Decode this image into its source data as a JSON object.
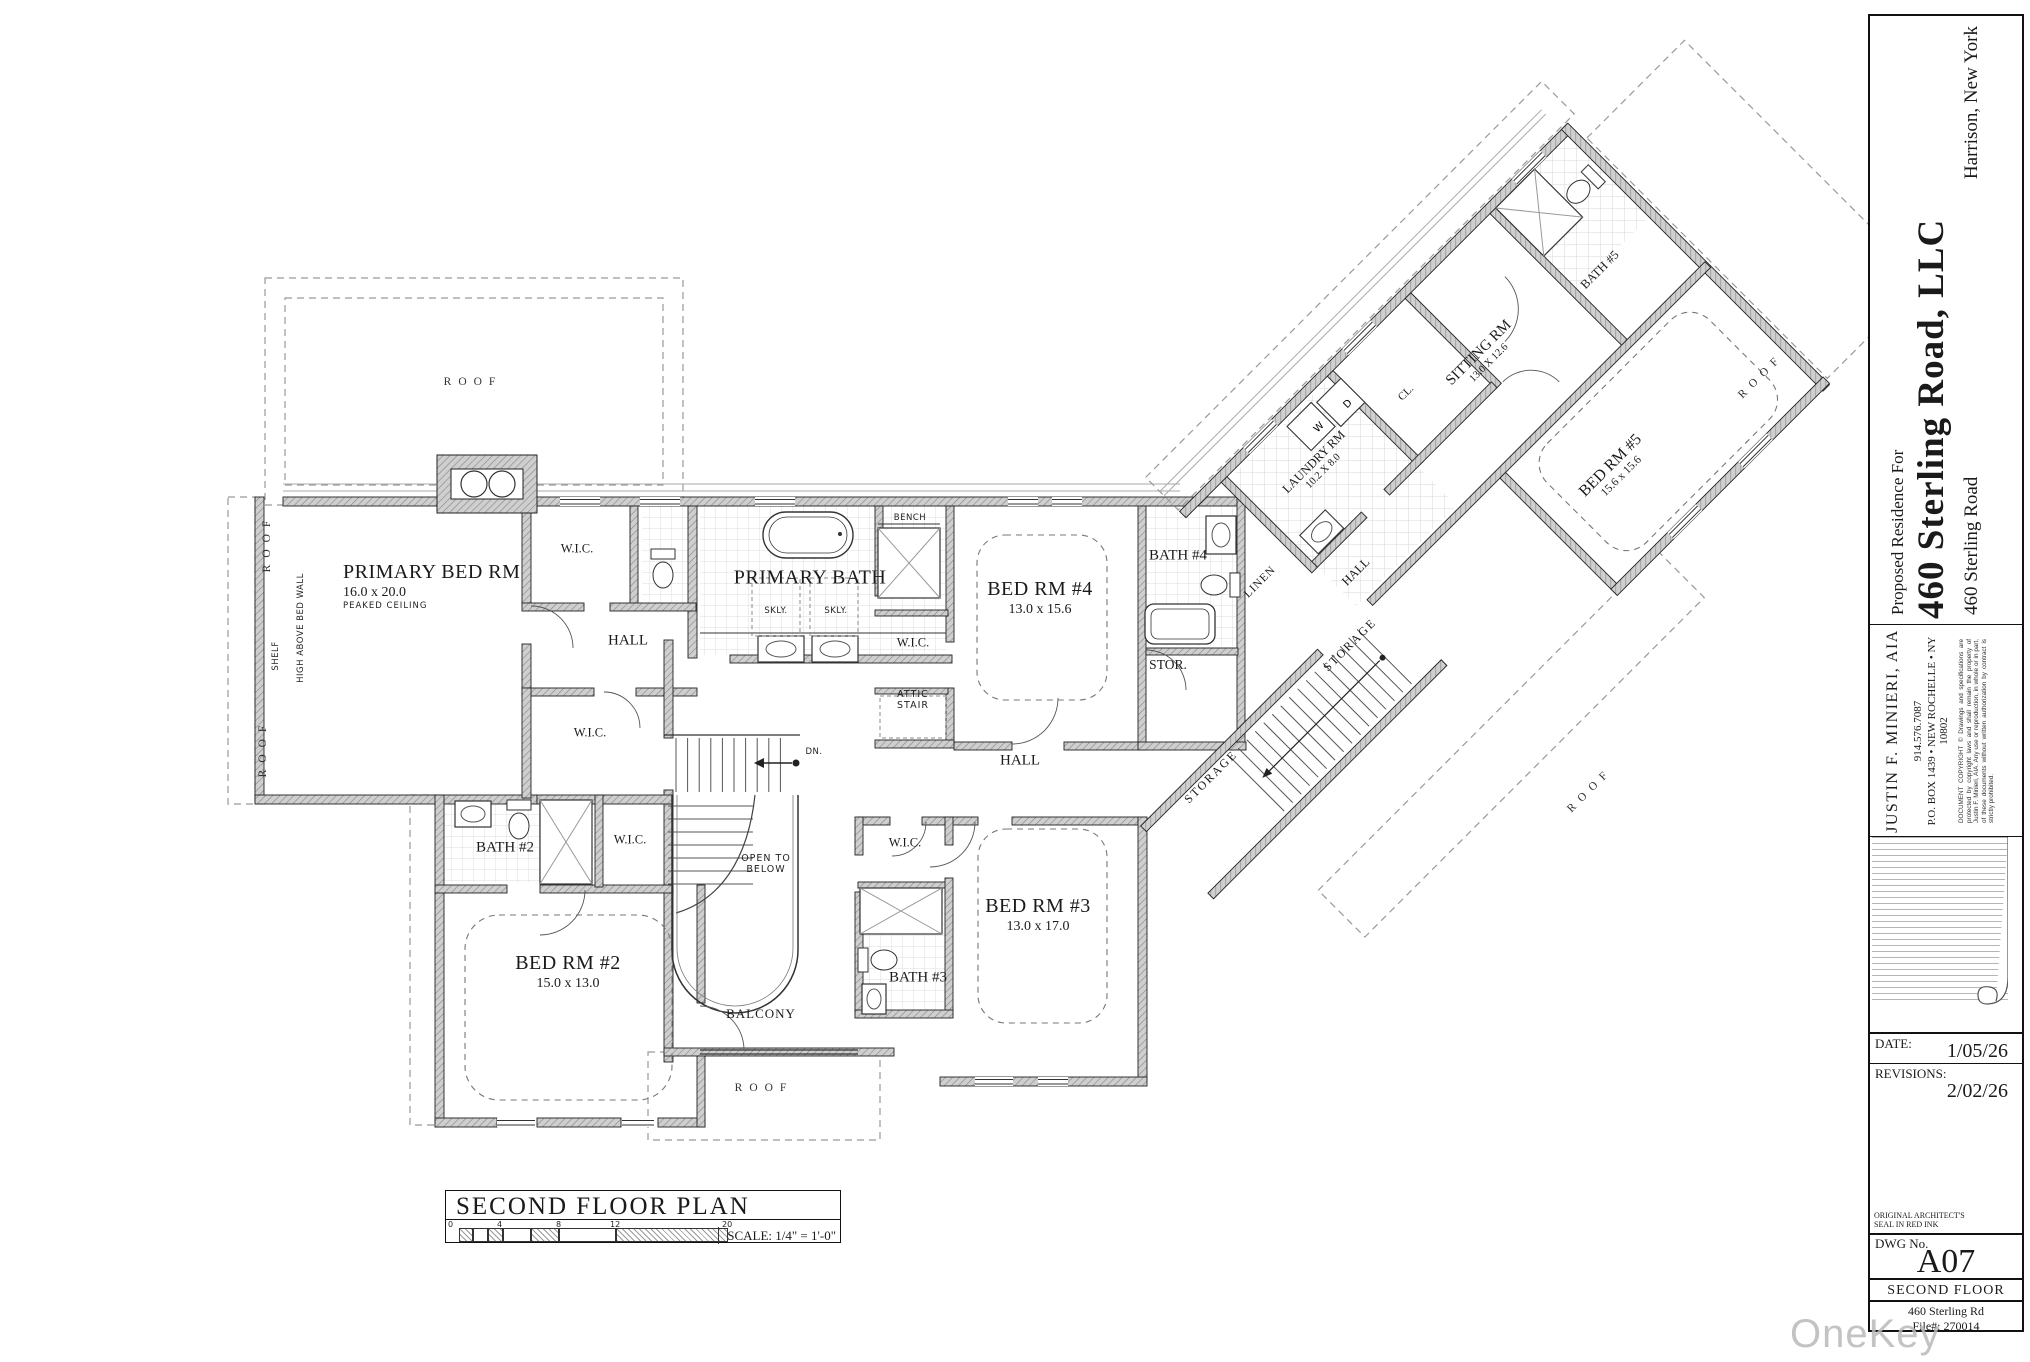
{
  "plan": {
    "rooms": {
      "primary_bed": {
        "name": "PRIMARY BED RM",
        "dims": "16.0 x 20.0",
        "note": "PEAKED CEILING"
      },
      "primary_bath": {
        "name": "PRIMARY BATH"
      },
      "bed2": {
        "name": "BED RM #2",
        "dims": "15.0 x 13.0"
      },
      "bed3": {
        "name": "BED RM #3",
        "dims": "13.0 x 17.0"
      },
      "bed4": {
        "name": "BED RM #4",
        "dims": "13.0 x 15.6"
      },
      "bed5": {
        "name": "BED RM #5",
        "dims": "15.6 x 15.6"
      },
      "sitting": {
        "name": "SITTING RM",
        "dims": "13.0 X 12.6"
      },
      "laundry": {
        "name": "LAUNDRY RM",
        "dims": "10.2 X 8.0"
      },
      "bath2": {
        "name": "BATH #2"
      },
      "bath3": {
        "name": "BATH #3"
      },
      "bath4": {
        "name": "BATH #4"
      },
      "bath5": {
        "name": "BATH #5"
      }
    },
    "labels": {
      "wic": "W.I.C.",
      "hall": "HALL",
      "roof": "ROOF",
      "balcony": "BALCONY",
      "stor": "STOR.",
      "storage": "STORAGE",
      "linen": "LINEN",
      "cl": "CL.",
      "bench": "BENCH",
      "skly": "SKLY.",
      "attic_1": "ATTIC",
      "attic_2": "STAIR",
      "open_below_1": "OPEN TO",
      "open_below_2": "BELOW",
      "dn": "DN.",
      "shelf": "SHELF",
      "high_above": "HIGH ABOVE BED WALL",
      "w": "W",
      "d": "D"
    }
  },
  "title_box": {
    "title": "SECOND FLOOR PLAN",
    "scale": "SCALE: 1/4\" = 1'-0\"",
    "ticks": [
      "0",
      "4",
      "8",
      "12",
      "20"
    ]
  },
  "title_block": {
    "proposed_for": "Proposed Residence For",
    "owner": "460 Sterling Road, LLC",
    "location": "Harrison, New York",
    "address": "460 Sterling Road",
    "architect": "JUSTIN F. MINIERI, AIA",
    "phone": "914.576.7087",
    "po_box": "P.O. BOX 1439 • NEW ROCHELLE • NY 10802",
    "copyright": "DOCUMENT COPYRIGHT © Drawings and specifications are protected by copyright laws and shall remain the property of Justin F. Minieri, AIA. Any use or reproduction, in whole or in part, of these documents without written authorization by contract is strictly prohibited.",
    "date_label": "DATE:",
    "date": "1/05/26",
    "revisions_label": "REVISIONS:",
    "revisions": "2/02/26",
    "seal_note_1": "ORIGINAL ARCHITECT'S",
    "seal_note_2": "SEAL IN RED INK",
    "dwg_label": "DWG No.",
    "dwg_no": "A07",
    "sheet_title": "SECOND FLOOR",
    "footer_address": "460 Sterling Rd",
    "file_no": "File#: 270014"
  },
  "watermark": "OneKey MLS",
  "colors": {
    "wall_fill": "#cfcfcf",
    "wall_hatch_line": "#8a8a8a",
    "line": "#222",
    "dash": "#999",
    "tile": "#dcdcdc",
    "watermark": "#b9b9b9"
  }
}
